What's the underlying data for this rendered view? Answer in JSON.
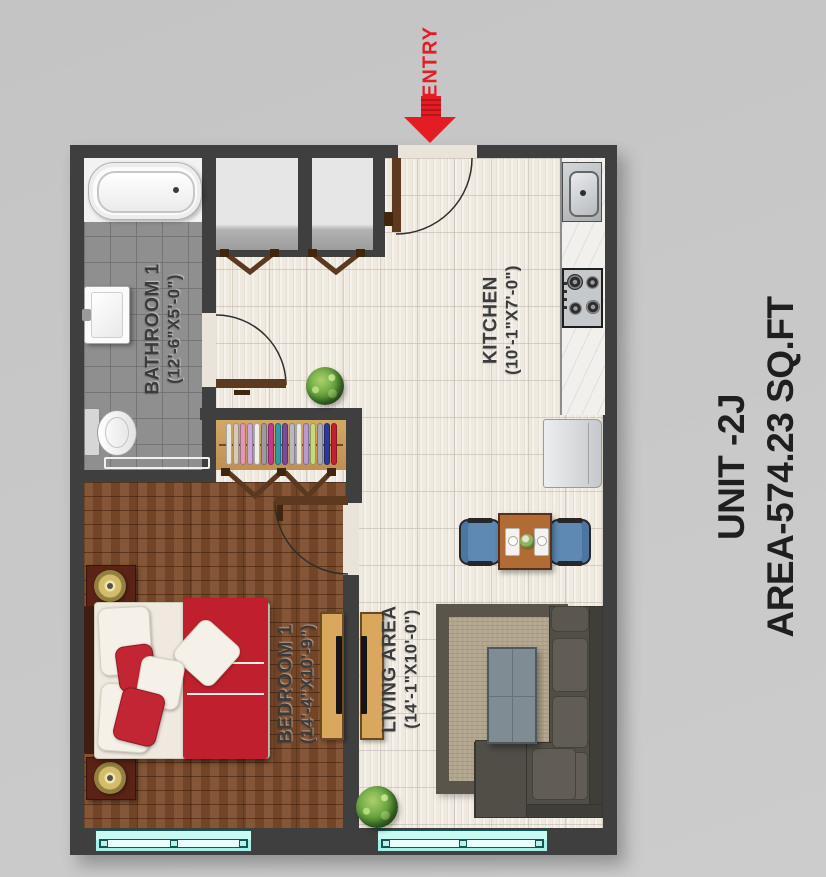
{
  "unit_info": {
    "unit_line": "UNIT -2J",
    "area_line": "AREA-574.23 SQ.FT"
  },
  "entry": {
    "label": "ENTRY"
  },
  "rooms": {
    "bathroom": {
      "name": "BATHROOM 1",
      "dimensions": "(12'-6\"X5'-0\")"
    },
    "kitchen": {
      "name": "KITCHEN",
      "dimensions": "(10'-1\"X7'-0\")"
    },
    "bedroom": {
      "name": "BEDROOM 1",
      "dimensions": "(14'-4\"X10'-9\")"
    },
    "living": {
      "name": "LIVING AREA",
      "dimensions": "(14'-1\"X10'-0\")"
    }
  },
  "wardrobe": {
    "clothes_colors": [
      "#e8e4da",
      "#d9c7b8",
      "#e09ab0",
      "#c9a8d8",
      "#f0eee8",
      "#9a9aa0",
      "#c23a8c",
      "#2e9aa8",
      "#7a4a9a",
      "#b8b8c0",
      "#ece8e0",
      "#b89ad0",
      "#c8d87a",
      "#a8a8b0",
      "#2a3a9a",
      "#c02030"
    ]
  },
  "colors": {
    "background": "#c9c9c9",
    "wall": "#3f3f3f",
    "tile_floor": "#efe9e0",
    "bathroom_tile": "#8f8f8f",
    "wood_floor": "#7c4a2b",
    "accent_red": "#e41d24",
    "duvet_red": "#c0202e",
    "chair_blue": "#5d89b2",
    "window_cyan": "#a7f0e8",
    "sofa_gray": "#514e48",
    "door_brown": "#5d3a1f"
  }
}
